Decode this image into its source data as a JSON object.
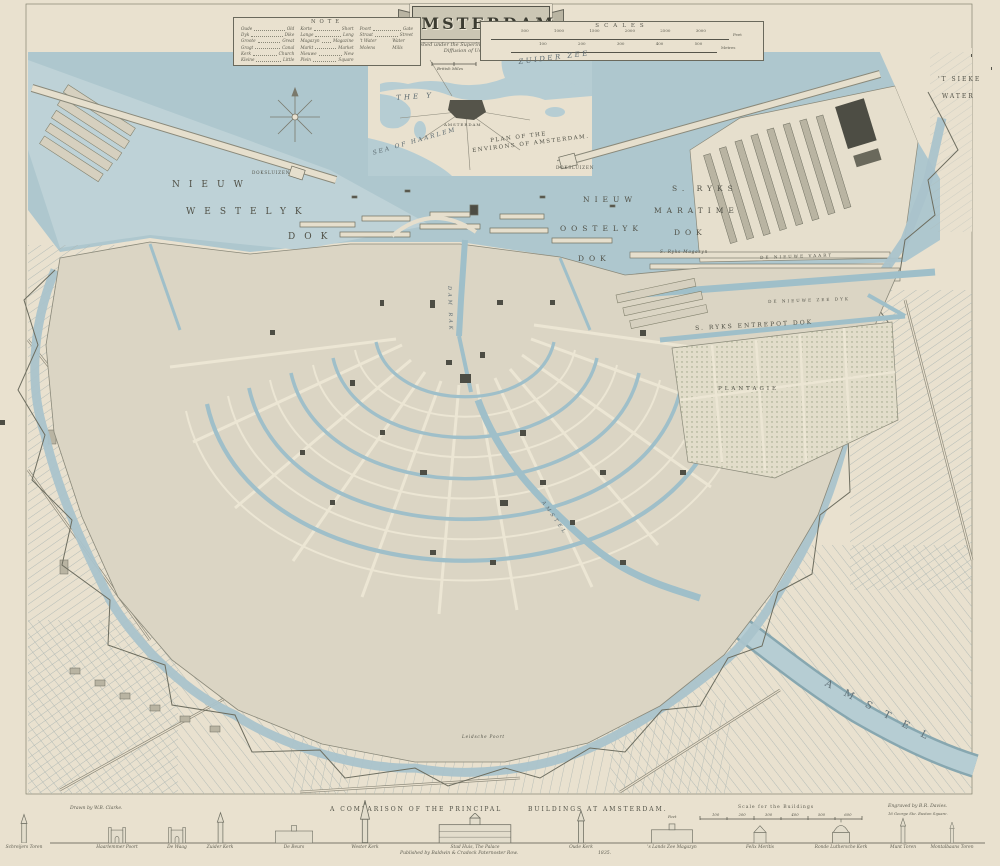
{
  "title_banner": {
    "title": "AMSTERDAM"
  },
  "publication": {
    "line1": "Published under the Superintendence of the Society for the",
    "line2": "Diffusion of Useful Knowledge."
  },
  "note_box": {
    "heading": "NOTE",
    "columns": [
      {
        "entries": [
          {
            "d": "Oude",
            "e": "Old"
          },
          {
            "d": "Dyk",
            "e": "Dike"
          },
          {
            "d": "Groote",
            "e": "Great"
          },
          {
            "d": "Gragt",
            "e": "Canal"
          },
          {
            "d": "Kerk",
            "e": "Church"
          },
          {
            "d": "Kleine",
            "e": "Little"
          }
        ]
      },
      {
        "entries": [
          {
            "d": "Korte",
            "e": "Short"
          },
          {
            "d": "Lange",
            "e": "Long"
          },
          {
            "d": "Magazyn",
            "e": "Magazine"
          },
          {
            "d": "Markt",
            "e": "Market"
          },
          {
            "d": "Nieuwe",
            "e": "New"
          },
          {
            "d": "Plein",
            "e": "Square"
          }
        ]
      },
      {
        "entries": [
          {
            "d": "Poort",
            "e": "Gate"
          },
          {
            "d": "Straat",
            "e": "Street"
          },
          {
            "d": "'t Water Molens",
            "e": "Water Mills"
          }
        ]
      }
    ]
  },
  "scales_box": {
    "heading": "SCALES",
    "bar1_numbers": "500 1000 1500 2000 2500 3000",
    "bar1_unit": "Feet",
    "bar2_numbers": "100 200 300 400 500",
    "bar2_unit": "Metres"
  },
  "inset": {
    "labels": {
      "zuider_zee": "ZUIDER ZEE",
      "the_y": "THE  Y",
      "amsterdam": "AMSTERDAM",
      "sea_of_haarlem": "SEA  OF  HAARLEM",
      "plan1": "PLAN OF THE",
      "plan2": "ENVIRONS OF AMSTERDAM.",
      "miles": "British Miles"
    }
  },
  "map_labels": {
    "nieuw_w_1": "NIEUW",
    "nieuw_w_2": "WESTELYK",
    "nieuw_w_3": "DOK",
    "doksluizen_w": "DOKSLUIZEN",
    "doksluizen_e": "DOKSLUIZEN",
    "nieuw_o_1": "NIEUW",
    "nieuw_o_2": "OOSTELYK",
    "nieuw_o_3": "DOK",
    "ryks_1": "S. RYKS",
    "ryks_2": "MARATIME",
    "ryks_3": "DOK",
    "ryks_magazyn": "S. Ryks Magazyn",
    "sieke_1": "'T SIEKE",
    "sieke_2": "WATER",
    "nieuwe_vaart": "DE NIEUWE VAART",
    "nieuwe_zeedyk": "DE NIEUWE ZEE DYK",
    "entrepot": "S. RYKS   ENTREPOT   DOK",
    "plantagie": "PLANTAGIE",
    "damrak": "DAM RAK",
    "amstel_city": "AMSTEL",
    "amstel_river": "AMSTEL",
    "leidsche_poort": "Leidsche Poort"
  },
  "comparison": {
    "title_part1": "A COMPARISON OF THE PRINCIPAL",
    "title_part2": "BUILDINGS AT AMSTERDAM.",
    "scale_label": "Scale for the Buildings",
    "scale_numbers": "100 200 300 400 500 600",
    "scale_unit": "Feet",
    "buildings": [
      {
        "name": "Schreijers Toren"
      },
      {
        "name": "Haarlemmer Poort"
      },
      {
        "name": "De Waag"
      },
      {
        "name": "Zuider Kerk"
      },
      {
        "name": "De Beurs"
      },
      {
        "name": "Wester Kerk"
      },
      {
        "name": "Stad Huis, The Palace"
      },
      {
        "name": "Oude Kerk"
      },
      {
        "name": "'s Lands Zee Magazyn"
      },
      {
        "name": "Felix Meritis"
      },
      {
        "name": "Ronde Luthersche Kerk"
      },
      {
        "name": "Munt Toren"
      },
      {
        "name": "Montalbaans Toren"
      }
    ]
  },
  "credits": {
    "drawn_by": "Drawn by W.B. Clarke.",
    "engraved_by": "Engraved by B.R. Davies.",
    "engraver_address": "16 George Ste. Euston Square.",
    "published": "Published by Baldwin & Cradock Paternoster Row.",
    "year": "1835."
  },
  "colors": {
    "water": "#aac3cb",
    "paper": "#e9e1cf",
    "block": "#dbd5c4",
    "ink": "#55544a"
  }
}
